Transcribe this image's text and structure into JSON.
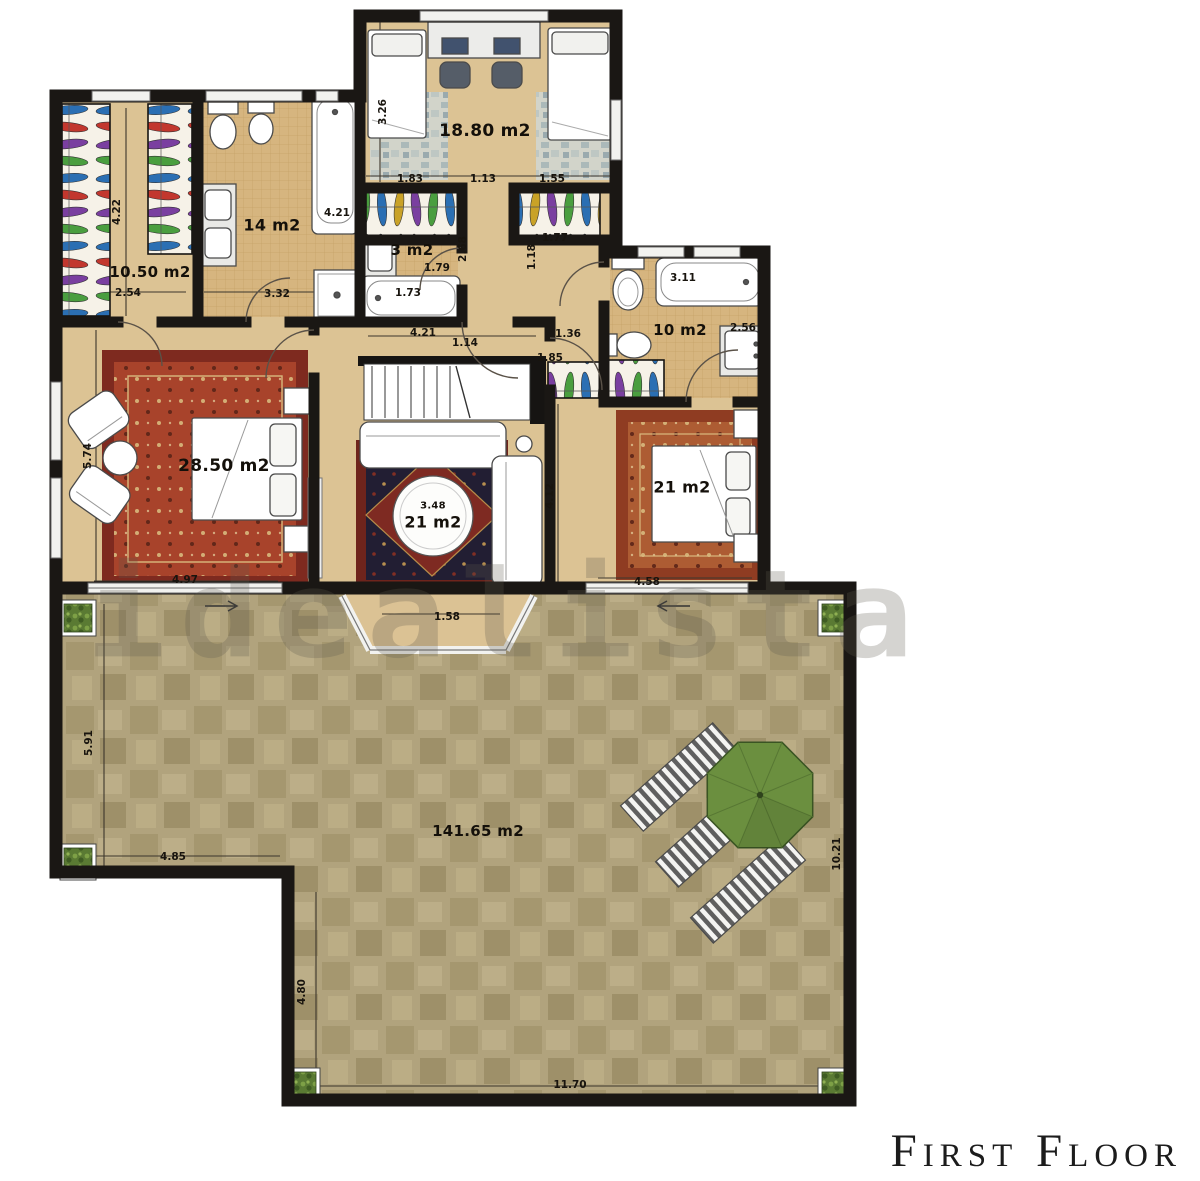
{
  "title": "First Floor",
  "watermark": "idealista",
  "room_labels": {
    "kids_bedroom": "18.80 m2",
    "dressing": "10.50 m2",
    "bath_main": "14 m2",
    "bath_small": "3 m2",
    "bath_right": "10 m2",
    "master_bedroom": "28.50 m2",
    "sitting_table_diameter": "3.48",
    "sitting_room": "21 m2",
    "bedroom_right": "21 m2",
    "terrace": "141.65 m2"
  },
  "dimensions": [
    {
      "value": "3.26",
      "x": 383,
      "y": 112,
      "vertical": true
    },
    {
      "value": "1.83",
      "x": 410,
      "y": 179
    },
    {
      "value": "1.13",
      "x": 483,
      "y": 179
    },
    {
      "value": "1.55",
      "x": 552,
      "y": 179
    },
    {
      "value": "4.22",
      "x": 117,
      "y": 212,
      "vertical": true
    },
    {
      "value": "4.21",
      "x": 337,
      "y": 213
    },
    {
      "value": "2.54",
      "x": 128,
      "y": 293
    },
    {
      "value": "3.32",
      "x": 277,
      "y": 294
    },
    {
      "value": "2.68",
      "x": 463,
      "y": 249,
      "vertical": true
    },
    {
      "value": "1.79",
      "x": 437,
      "y": 268
    },
    {
      "value": "1.73",
      "x": 408,
      "y": 293
    },
    {
      "value": "1.18",
      "x": 532,
      "y": 257,
      "vertical": true
    },
    {
      "value": "1.77",
      "x": 555,
      "y": 238
    },
    {
      "value": "3.11",
      "x": 683,
      "y": 278
    },
    {
      "value": "2.56",
      "x": 743,
      "y": 328
    },
    {
      "value": "4.21",
      "x": 423,
      "y": 333
    },
    {
      "value": "1.14",
      "x": 465,
      "y": 343
    },
    {
      "value": "1.36",
      "x": 568,
      "y": 334
    },
    {
      "value": "1.85",
      "x": 550,
      "y": 358
    },
    {
      "value": "5.74",
      "x": 88,
      "y": 456,
      "vertical": true
    },
    {
      "value": "4.12",
      "x": 550,
      "y": 496,
      "vertical": true
    },
    {
      "value": "4.97",
      "x": 185,
      "y": 580
    },
    {
      "value": "4.58",
      "x": 647,
      "y": 582
    },
    {
      "value": "1.58",
      "x": 447,
      "y": 617
    },
    {
      "value": "5.91",
      "x": 89,
      "y": 743,
      "vertical": true
    },
    {
      "value": "4.85",
      "x": 173,
      "y": 857
    },
    {
      "value": "10.21",
      "x": 837,
      "y": 854,
      "vertical": true
    },
    {
      "value": "4.80",
      "x": 302,
      "y": 992,
      "vertical": true
    },
    {
      "value": "11.70",
      "x": 570,
      "y": 1085
    }
  ]
}
